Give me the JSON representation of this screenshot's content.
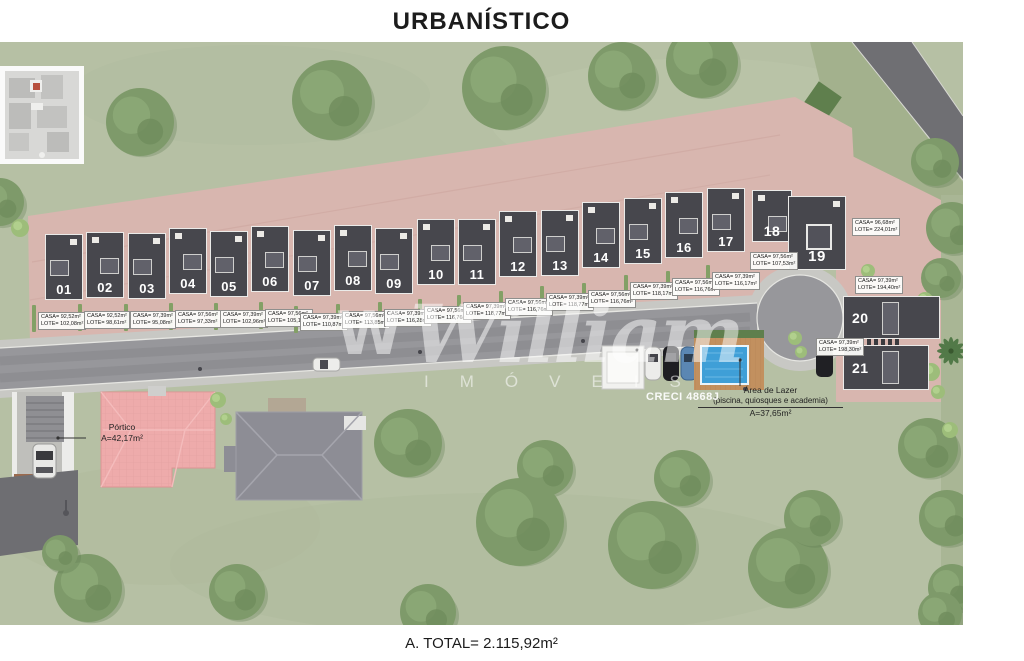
{
  "title": "URBANÍSTICO",
  "footer": {
    "total_label": "A. TOTAL= 2.115,92m²"
  },
  "watermark": {
    "logo": "W",
    "brand": "William",
    "subtitle": "IMÓVEIS",
    "creci": "CRECI 4868J"
  },
  "annotations": {
    "portico": {
      "name": "Pórtico",
      "area": "A=42,17m²"
    },
    "leisure": {
      "title": "Área de Lazer",
      "subtitle": "(piscina, quiosques e academia)",
      "area": "A=37,65m²"
    }
  },
  "colors": {
    "grass": "#b6c0a4",
    "tree": "#7e9a6a",
    "pavers": "#d8b6af",
    "road": "#97979b",
    "sidewalk": "#c8c8c4",
    "roof_dark": "#47474d",
    "pool_blue": "#3f9fd7",
    "deck": "#c2905f",
    "pink_roof": "#eeabab",
    "gray_roof": "#8d8d95"
  },
  "lots": [
    {
      "num": "01",
      "casa": "CASA= 92,52m²",
      "lote": "LOTE= 102,08m²"
    },
    {
      "num": "02",
      "casa": "CASA= 92,52m²",
      "lote": "LOTE= 98,61m²"
    },
    {
      "num": "03",
      "casa": "CASA= 97,39m²",
      "lote": "LOTE= 95,08m²"
    },
    {
      "num": "04",
      "casa": "CASA= 97,56m²",
      "lote": "LOTE= 97,33m²"
    },
    {
      "num": "05",
      "casa": "CASA= 97,39m²",
      "lote": "LOTE= 102,96m²"
    },
    {
      "num": "06",
      "casa": "CASA= 97,56m²",
      "lote": "LOTE= 105,11m²"
    },
    {
      "num": "07",
      "casa": "CASA= 97,39m²",
      "lote": "LOTE= 110,87m²"
    },
    {
      "num": "08",
      "casa": "CASA= 97,56m²",
      "lote": "LOTE= 113,85m²"
    },
    {
      "num": "09",
      "casa": "CASA= 97,39m²",
      "lote": "LOTE= 116,28m²"
    },
    {
      "num": "10",
      "casa": "CASA= 97,56m²",
      "lote": "LOTE= 116,76m²"
    },
    {
      "num": "11",
      "casa": "CASA= 97,39m²",
      "lote": "LOTE= 118,77m²"
    },
    {
      "num": "12",
      "casa": "CASA= 97,56m²",
      "lote": "LOTE= 116,76m²"
    },
    {
      "num": "13",
      "casa": "CASA= 97,39m²",
      "lote": "LOTE= 118,77m²"
    },
    {
      "num": "14",
      "casa": "CASA= 97,56m²",
      "lote": "LOTE= 116,76m²"
    },
    {
      "num": "15",
      "casa": "CASA= 97,39m²",
      "lote": "LOTE= 118,17m²"
    },
    {
      "num": "16",
      "casa": "CASA= 97,56m²",
      "lote": "LOTE= 116,76m²"
    },
    {
      "num": "17",
      "casa": "CASA= 97,39m²",
      "lote": "LOTE= 116,17m²"
    },
    {
      "num": "18",
      "casa": "CASA= 97,56m²",
      "lote": "LOTE= 107,53m²"
    },
    {
      "num": "19",
      "casa": "CASA= 96,68m²",
      "lote": "LOTE= 224,01m²"
    },
    {
      "num": "20",
      "casa": "CASA= 97,39m²",
      "lote": "LOTE= 194,40m²"
    },
    {
      "num": "21",
      "casa": "CASA= 97,39m²",
      "lote": "LOTE= 198,30m²"
    }
  ]
}
